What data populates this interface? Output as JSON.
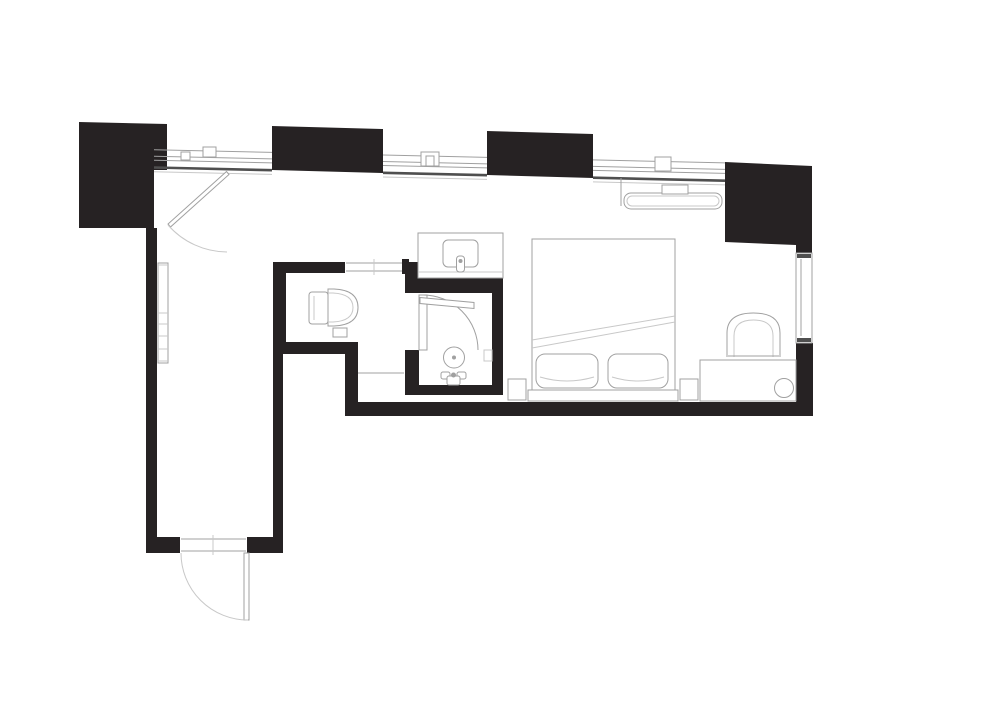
{
  "meta": {
    "type": "architectural-floor-plan",
    "description": "Black-and-white CAD floor plan of a studio hotel room with entry corridor, bathroom (WC + walk-in shower), vanity, double bed, lounge chair and desk",
    "canvas": {
      "width": 1000,
      "height": 707
    }
  },
  "colors": {
    "background": "#ffffff",
    "wall": "#262223",
    "line": "#a0a0a0",
    "line_dark": "#4f4f4f",
    "line_light": "#c8c8c8",
    "fill_white": "#ffffff"
  },
  "inventory": {
    "structure": [
      "pier-1",
      "pier-2",
      "pier-3",
      "pier-4",
      "left-wall",
      "corridor-right-wall",
      "wc-walls",
      "shower-walls",
      "main-bottom-wall",
      "right-wall-lower"
    ],
    "windows": [
      "top-window-band-1",
      "top-window-band-2",
      "top-window-band-3",
      "right-side-window"
    ],
    "doors": [
      "entry-door-top",
      "bottom-entry-door",
      "bathroom-pocket-door",
      "shower-door"
    ],
    "fixtures": [
      "toilet",
      "toilet-paper-holder",
      "shower-drain",
      "shower-valve",
      "shower-shelf",
      "vanity-counter",
      "vanity-sink",
      "vanity-faucet",
      "wall-mirror",
      "fan-coil-bench"
    ],
    "furniture": [
      "double-bed",
      "pillow-left",
      "pillow-right",
      "headboard",
      "nightstand-left",
      "nightstand-right",
      "desk-console",
      "desk-stool",
      "lounge-chair",
      "storage-nook-shelf"
    ]
  }
}
